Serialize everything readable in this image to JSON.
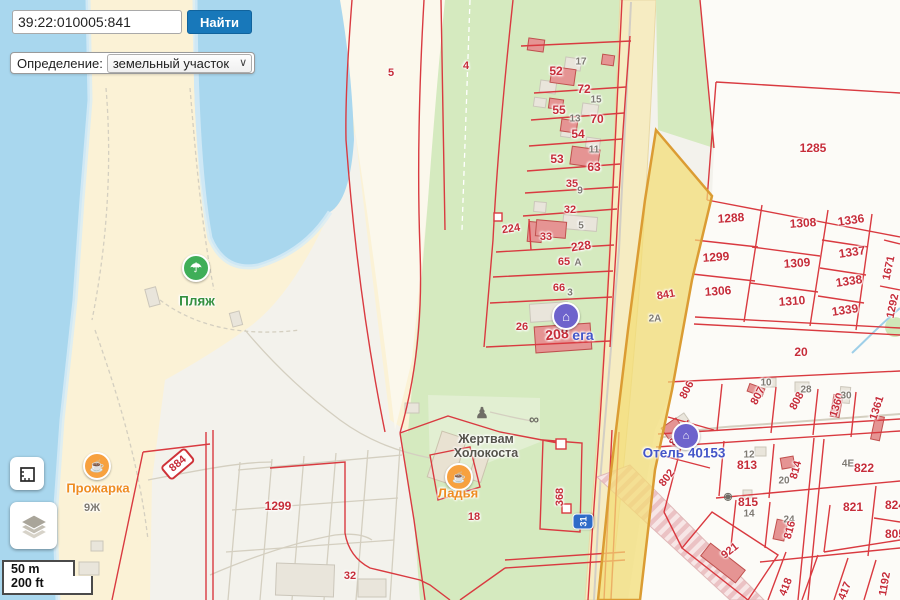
{
  "search": {
    "value": "39:22:010005:841",
    "button_label": "Найти"
  },
  "filter": {
    "label": "Определение:",
    "selected": "земельный участок"
  },
  "scale": {
    "metric": "50 m",
    "imperial": "200 ft"
  },
  "colors": {
    "accent_blue": "#1878ba",
    "parcel_red": "#c62d39",
    "house_gray": "#7e7a72",
    "highlight_yellow": "#f3dd73",
    "highlight_border": "#db9c33",
    "water": "#a9d7ee",
    "sand": "#fbf2d6",
    "park_green": "#d5eabf",
    "poi_orange": "#f7a13f",
    "poi_green": "#3fae58",
    "poi_purple": "#6e63cc",
    "poi_blue_text": "#4456c8"
  },
  "map": {
    "road_shield": {
      "text": "31"
    },
    "parcel_labels": [
      {
        "t": "5",
        "x": 391,
        "y": 73,
        "c": "r",
        "s": 11
      },
      {
        "t": "4",
        "x": 466,
        "y": 66,
        "c": "r",
        "s": 11
      },
      {
        "t": "52",
        "x": 556,
        "y": 71,
        "c": "r",
        "s": 12
      },
      {
        "t": "17",
        "x": 581,
        "y": 62,
        "c": "g",
        "s": 10
      },
      {
        "t": "72",
        "x": 584,
        "y": 89,
        "c": "r",
        "s": 12
      },
      {
        "t": "55",
        "x": 559,
        "y": 110,
        "c": "r",
        "s": 12
      },
      {
        "t": "15",
        "x": 596,
        "y": 100,
        "c": "g",
        "s": 10
      },
      {
        "t": "70",
        "x": 597,
        "y": 119,
        "c": "r",
        "s": 12
      },
      {
        "t": "13",
        "x": 575,
        "y": 119,
        "c": "g",
        "s": 10
      },
      {
        "t": "54",
        "x": 578,
        "y": 134,
        "c": "r",
        "s": 12
      },
      {
        "t": "53",
        "x": 557,
        "y": 159,
        "c": "r",
        "s": 12
      },
      {
        "t": "11",
        "x": 594,
        "y": 150,
        "c": "g",
        "s": 10
      },
      {
        "t": "63",
        "x": 594,
        "y": 167,
        "c": "r",
        "s": 12
      },
      {
        "t": "35",
        "x": 572,
        "y": 184,
        "c": "r",
        "s": 11
      },
      {
        "t": "9",
        "x": 580,
        "y": 191,
        "c": "g",
        "s": 10
      },
      {
        "t": "32",
        "x": 570,
        "y": 210,
        "c": "r",
        "s": 11
      },
      {
        "t": "224",
        "x": 511,
        "y": 229,
        "c": "r",
        "s": 11,
        "rot": -8
      },
      {
        "t": "33",
        "x": 546,
        "y": 237,
        "c": "r",
        "s": 11
      },
      {
        "t": "5",
        "x": 581,
        "y": 226,
        "c": "g",
        "s": 10
      },
      {
        "t": "228",
        "x": 581,
        "y": 246,
        "c": "r",
        "s": 12,
        "rot": -8
      },
      {
        "t": "65",
        "x": 564,
        "y": 262,
        "c": "r",
        "s": 11
      },
      {
        "t": "А",
        "x": 578,
        "y": 263,
        "c": "g",
        "s": 10
      },
      {
        "t": "66",
        "x": 559,
        "y": 288,
        "c": "r",
        "s": 11
      },
      {
        "t": "3",
        "x": 570,
        "y": 293,
        "c": "g",
        "s": 10
      },
      {
        "t": "26",
        "x": 522,
        "y": 327,
        "c": "r",
        "s": 11
      },
      {
        "t": "208",
        "x": 557,
        "y": 334,
        "c": "r",
        "s": 14,
        "rot": -6
      },
      {
        "t": "18",
        "x": 474,
        "y": 517,
        "c": "r",
        "s": 11
      },
      {
        "t": "368",
        "x": 560,
        "y": 497,
        "c": "r",
        "s": 11,
        "rot": -90
      },
      {
        "t": "1299",
        "x": 278,
        "y": 506,
        "c": "r",
        "s": 12
      },
      {
        "t": "32",
        "x": 350,
        "y": 576,
        "c": "r",
        "s": 11
      },
      {
        "t": "884",
        "x": 178,
        "y": 464,
        "c": "r",
        "s": 11,
        "rot": -40,
        "boxed": true
      },
      {
        "t": "841",
        "x": 666,
        "y": 295,
        "c": "r",
        "s": 11,
        "rot": -10
      },
      {
        "t": "2А",
        "x": 655,
        "y": 319,
        "c": "g",
        "s": 10
      },
      {
        "t": "1285",
        "x": 813,
        "y": 148,
        "c": "r",
        "s": 12
      },
      {
        "t": "1288",
        "x": 731,
        "y": 218,
        "c": "r",
        "s": 12,
        "rot": -4
      },
      {
        "t": "1308",
        "x": 803,
        "y": 223,
        "c": "r",
        "s": 12,
        "rot": -4
      },
      {
        "t": "1336",
        "x": 851,
        "y": 220,
        "c": "r",
        "s": 12,
        "rot": -8
      },
      {
        "t": "1299",
        "x": 716,
        "y": 257,
        "c": "r",
        "s": 12,
        "rot": -4
      },
      {
        "t": "1309",
        "x": 797,
        "y": 263,
        "c": "r",
        "s": 12,
        "rot": -4
      },
      {
        "t": "1337",
        "x": 852,
        "y": 252,
        "c": "r",
        "s": 12,
        "rot": -8
      },
      {
        "t": "1306",
        "x": 718,
        "y": 291,
        "c": "r",
        "s": 12,
        "rot": -4
      },
      {
        "t": "1310",
        "x": 792,
        "y": 301,
        "c": "r",
        "s": 12,
        "rot": -4
      },
      {
        "t": "1338",
        "x": 849,
        "y": 281,
        "c": "r",
        "s": 12,
        "rot": -8
      },
      {
        "t": "1339",
        "x": 845,
        "y": 310,
        "c": "r",
        "s": 12,
        "rot": -8
      },
      {
        "t": "1671",
        "x": 889,
        "y": 268,
        "c": "r",
        "s": 11,
        "rot": -78
      },
      {
        "t": "1292",
        "x": 893,
        "y": 306,
        "c": "r",
        "s": 11,
        "rot": -78
      },
      {
        "t": "20",
        "x": 801,
        "y": 352,
        "c": "r",
        "s": 12
      },
      {
        "t": "806",
        "x": 687,
        "y": 390,
        "c": "r",
        "s": 11,
        "rot": -62
      },
      {
        "t": "807",
        "x": 758,
        "y": 396,
        "c": "r",
        "s": 11,
        "rot": -62
      },
      {
        "t": "10",
        "x": 766,
        "y": 383,
        "c": "g",
        "s": 10
      },
      {
        "t": "808",
        "x": 797,
        "y": 401,
        "c": "r",
        "s": 11,
        "rot": -62
      },
      {
        "t": "28",
        "x": 806,
        "y": 390,
        "c": "g",
        "s": 10
      },
      {
        "t": "1360",
        "x": 837,
        "y": 405,
        "c": "r",
        "s": 11,
        "rot": -72
      },
      {
        "t": "30",
        "x": 846,
        "y": 396,
        "c": "g",
        "s": 10
      },
      {
        "t": "1361",
        "x": 877,
        "y": 408,
        "c": "r",
        "s": 11,
        "rot": -72
      },
      {
        "t": "803",
        "x": 677,
        "y": 437,
        "c": "r",
        "s": 11,
        "rot": -58
      },
      {
        "t": "802",
        "x": 667,
        "y": 478,
        "c": "r",
        "s": 11,
        "rot": -52
      },
      {
        "t": "813",
        "x": 747,
        "y": 465,
        "c": "r",
        "s": 12
      },
      {
        "t": "12",
        "x": 749,
        "y": 455,
        "c": "g",
        "s": 10
      },
      {
        "t": "814",
        "x": 796,
        "y": 470,
        "c": "r",
        "s": 11,
        "rot": -75
      },
      {
        "t": "20",
        "x": 784,
        "y": 481,
        "c": "g",
        "s": 10
      },
      {
        "t": "4Е",
        "x": 848,
        "y": 464,
        "c": "g",
        "s": 10
      },
      {
        "t": "822",
        "x": 864,
        "y": 468,
        "c": "r",
        "s": 12
      },
      {
        "t": "815",
        "x": 748,
        "y": 502,
        "c": "r",
        "s": 12
      },
      {
        "t": "14",
        "x": 749,
        "y": 514,
        "c": "g",
        "s": 10
      },
      {
        "t": "24",
        "x": 789,
        "y": 520,
        "c": "g",
        "s": 10
      },
      {
        "t": "816",
        "x": 790,
        "y": 530,
        "c": "r",
        "s": 11,
        "rot": -75
      },
      {
        "t": "821",
        "x": 853,
        "y": 507,
        "c": "r",
        "s": 12
      },
      {
        "t": "824",
        "x": 895,
        "y": 505,
        "c": "r",
        "s": 12
      },
      {
        "t": "805",
        "x": 895,
        "y": 534,
        "c": "r",
        "s": 12
      },
      {
        "t": "921",
        "x": 730,
        "y": 551,
        "c": "r",
        "s": 11,
        "rot": -38
      },
      {
        "t": "418",
        "x": 786,
        "y": 587,
        "c": "r",
        "s": 11,
        "rot": -68
      },
      {
        "t": "417",
        "x": 845,
        "y": 591,
        "c": "r",
        "s": 11,
        "rot": -68
      },
      {
        "t": "1192",
        "x": 885,
        "y": 584,
        "c": "r",
        "s": 11,
        "rot": -80
      },
      {
        "t": "9Ж",
        "x": 92,
        "y": 508,
        "c": "g",
        "s": 11
      }
    ],
    "pois": [
      {
        "name": "poi-beach",
        "glyph": "☂",
        "gs": 13,
        "circle": "#3fae58",
        "x": 196,
        "y": 268,
        "label": "Пляж",
        "label_color": "#35903f",
        "ls": 13.5,
        "lx": 197,
        "ly": 301
      },
      {
        "name": "poi-cafe-prozharka",
        "glyph": "☕",
        "gs": 12,
        "circle": "#f7a13f",
        "x": 97,
        "y": 466,
        "label": "Прожарка",
        "label_color": "#ee8c21",
        "ls": 13,
        "lx": 98,
        "ly": 489
      },
      {
        "name": "poi-cafe-ladya",
        "glyph": "☕",
        "gs": 11,
        "circle": "#f7a13f",
        "x": 459,
        "y": 477,
        "label": "Ладья",
        "label_color": "#ee8c21",
        "ls": 13,
        "lx": 458,
        "ly": 494
      },
      {
        "name": "poi-hotel-vega",
        "glyph": "⌂",
        "gs": 13,
        "circle": "#6e63cc",
        "x": 566,
        "y": 316,
        "label": "ега",
        "label_color": "#4456c8",
        "ls": 14,
        "lx": 583,
        "ly": 336
      },
      {
        "name": "poi-hotel-40153",
        "glyph": "⌂",
        "gs": 11,
        "circle": "#6e63cc",
        "x": 686,
        "y": 436,
        "label": "Отель 40153",
        "label_color": "#4456c8",
        "ls": 13.5,
        "lx": 684,
        "ly": 453
      },
      {
        "name": "poi-memorial",
        "glyph": "♟",
        "gs": 15,
        "x": 482,
        "y": 413,
        "label": "Жертвам Холокоста",
        "label_color": "#55534b",
        "ls": 12.5,
        "lx": 486,
        "ly": 446,
        "lw": 92
      },
      {
        "name": "poi-viewpoint-binoculars",
        "glyph": "∞",
        "gs": 14,
        "x": 534,
        "y": 419
      },
      {
        "name": "poi-photo",
        "glyph": "◉",
        "gs": 10,
        "x": 728,
        "y": 497
      }
    ]
  }
}
